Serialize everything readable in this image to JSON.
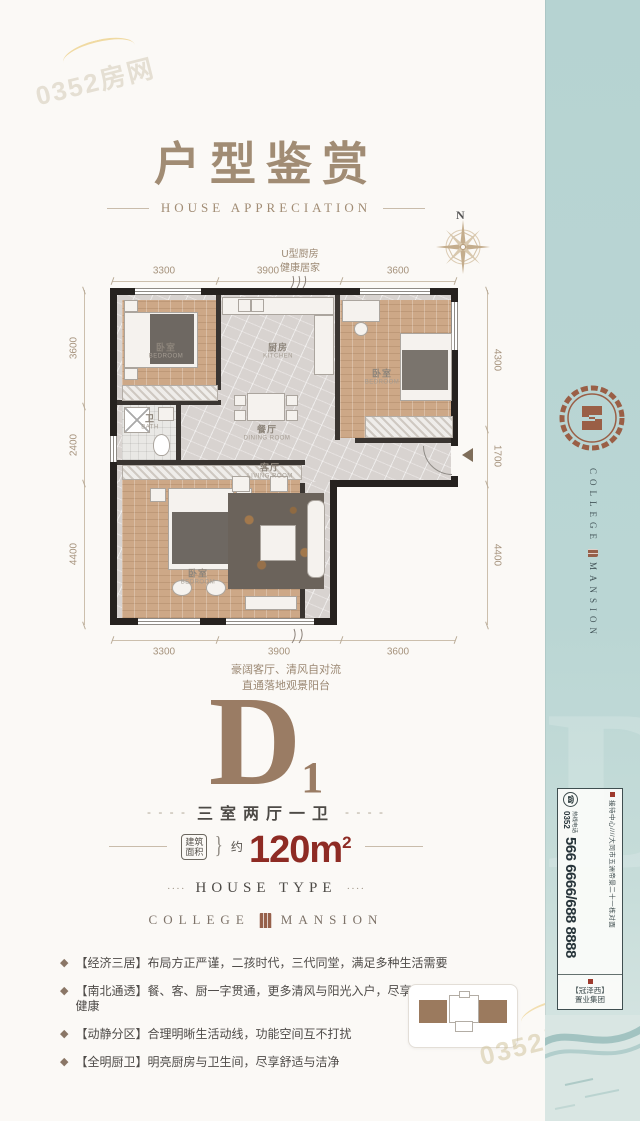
{
  "watermark": {
    "text": "0352房网"
  },
  "header": {
    "title": "户型鉴赏",
    "subtitle": "HOUSE APPRECIATION"
  },
  "compass": {
    "north_label": "N"
  },
  "floorplan": {
    "kitchen_note_line1": "U型厨房",
    "kitchen_note_line2": "健康居家",
    "dims_top": [
      "3300",
      "3900",
      "3600"
    ],
    "dims_bottom": [
      "3300",
      "3900",
      "3600"
    ],
    "dims_left": [
      "3600",
      "2400",
      "4400"
    ],
    "dims_right": [
      "4300",
      "1700",
      "4400"
    ],
    "rooms": [
      {
        "cn": "卧室",
        "en": "BEDROOM"
      },
      {
        "cn": "厨房",
        "en": "KITCHEN"
      },
      {
        "cn": "卧室",
        "en": "BEDROOM"
      },
      {
        "cn": "餐厅",
        "en": "DINING ROOM"
      },
      {
        "cn": "卫",
        "en": "BATH"
      },
      {
        "cn": "客厅",
        "en": "LIVING ROOM"
      },
      {
        "cn": "卧室",
        "en": "BEDROOM"
      }
    ],
    "balcony_note_line1": "豪阔客厅、清风自对流",
    "balcony_note_line2": "直通落地观景阳台"
  },
  "unit": {
    "letter": "D",
    "number": "1",
    "dashes": "- - - -",
    "layout": "三室两厅一卫",
    "area_label_line1": "建筑",
    "area_label_line2": "面积",
    "brace": "}",
    "area_approx": "约",
    "area_value": "120m",
    "area_sup": "2",
    "dots": "····",
    "house_type": "HOUSE TYPE"
  },
  "brand": {
    "left": "COLLEGE",
    "right": "MANSION"
  },
  "features": {
    "bullet": "◆",
    "items": [
      {
        "text": "【经济三居】布局方正严谨，二孩时代，三代同堂，满足多种生活需要"
      },
      {
        "text": "【南北通透】餐、客、厨一字贯通，更多清风与阳光入户，尽享舒适与健康"
      },
      {
        "text": "【动静分区】合理明晰生活动线，功能空间互不打扰"
      },
      {
        "text": "【全明厨卫】明亮厨房与卫生间，尽享舒适与洁净"
      }
    ]
  },
  "sidebar": {
    "phone": {
      "address": "接待中心////大同市五洲帝景二十一栋对面",
      "hotline_label": "热线电话",
      "area_code": "0352",
      "numbers": "566 6666/688 8888",
      "company_line1": "【冠泽西】",
      "company_line2": "置业集团"
    }
  },
  "colors": {
    "accent_red": "#8e2b24",
    "brand_brown": "#9a7c64",
    "sidebar_teal": "#b6d3d2"
  }
}
